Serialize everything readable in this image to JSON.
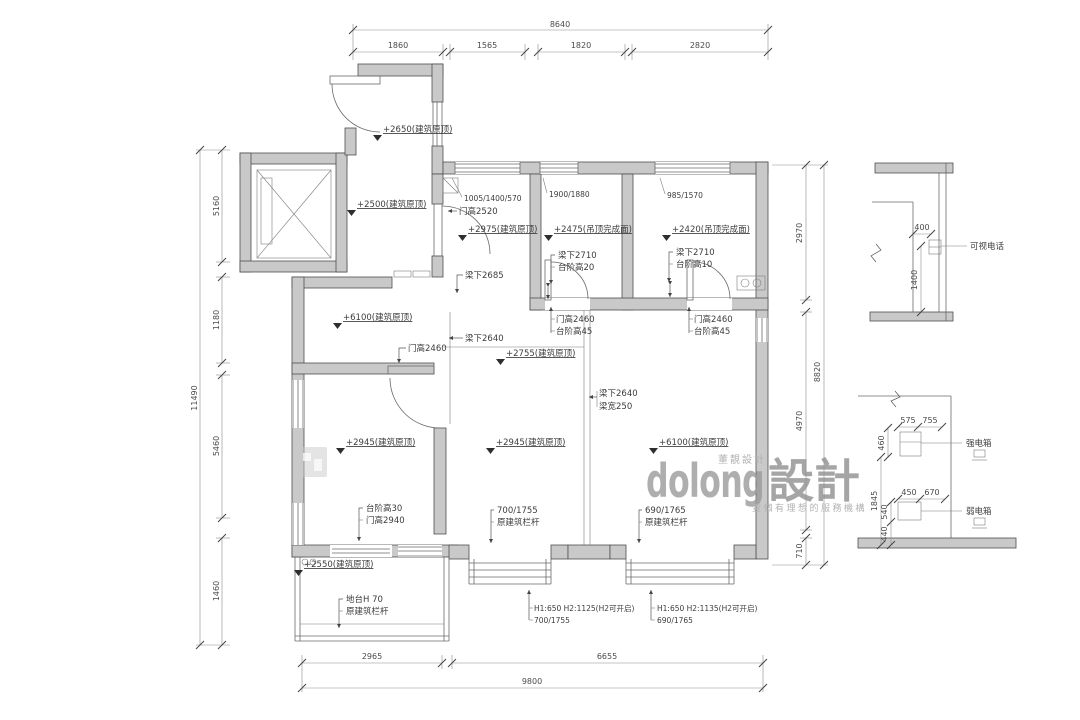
{
  "dims": {
    "top": {
      "total": "8640",
      "s": [
        "1860",
        "1565",
        "1820",
        "2820"
      ]
    },
    "left": {
      "total": "11490",
      "s": [
        "5160",
        "1180",
        "5460",
        "1460"
      ]
    },
    "right": {
      "total": "8820",
      "s": [
        "2970",
        "4970",
        "710"
      ]
    },
    "bottom": {
      "total": "9800",
      "s": [
        "2965",
        "6655"
      ]
    }
  },
  "ann": {
    "lvl2650": "+2650(建筑原顶)",
    "lvl2500": "+2500(建筑原顶)",
    "lvl2975": "+2975(建筑原顶)",
    "lvl2475": "+2475(吊顶完成面)",
    "lvl2420": "+2420(吊顶完成面)",
    "lvl6100": "+6100(建筑原顶)",
    "lvl2755": "+2755(建筑原顶)",
    "lvl2945": "+2945(建筑原顶)",
    "lvl2550": "+2550(建筑原顶)",
    "door2520": "门高2520",
    "door2460": "门高2460",
    "door2940": "门高2940",
    "win_a": "1005/1400/570",
    "win_b": "1900/1880",
    "win_c": "985/1570",
    "beam2710": "梁下2710",
    "beam2685": "梁下2685",
    "beam2640": "梁下2640",
    "beam_w": "梁宽250",
    "step20": "台阶高20",
    "step10": "台阶高10",
    "step45": "台阶高45",
    "step30": "台阶高30",
    "rail": "原建筑栏杆",
    "rail_a": "700/1755",
    "rail_b": "690/1765",
    "platform": "地台H 70",
    "open_a": "H1:650 H2:1125(H2可开启)",
    "open_b": "H1:650 H2:1135(H2可开启)",
    "intercom": "可视电话",
    "strongbox": "强电箱",
    "weakbox": "弱电箱"
  },
  "detail": {
    "d400": "400",
    "d1400": "1400",
    "d575": "575",
    "d755": "755",
    "d460": "460",
    "d1845": "1845",
    "d450": "450",
    "d670": "670",
    "d540": "540",
    "d440": "440"
  },
  "watermark": {
    "latin": "dolong",
    "cjk": "設計",
    "top": "董靚設計",
    "bottom": "壹個有理想的服務機構"
  }
}
